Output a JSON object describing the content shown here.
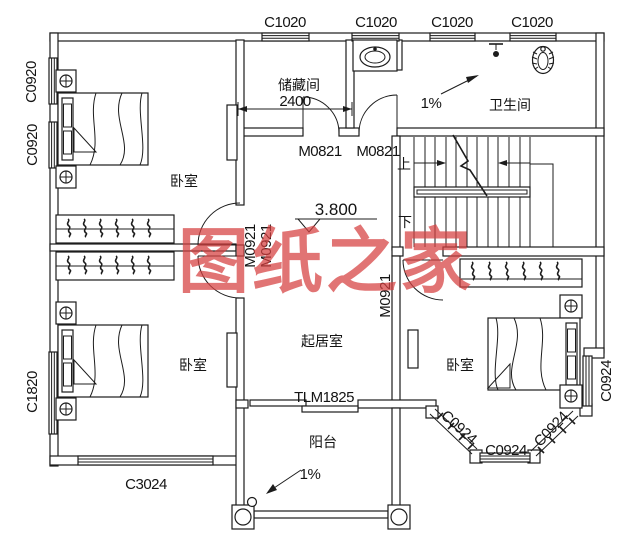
{
  "watermark": {
    "text": "图纸之家",
    "color": "#d64040"
  },
  "windows": {
    "top": [
      "C1020",
      "C1020",
      "C1020",
      "C1020"
    ],
    "left_upper": "C0920",
    "left_lower": "C0920",
    "left_bottom": "C1820",
    "bottom": "C3024",
    "bay": [
      "C0924",
      "C0924",
      "C0924",
      "C0924"
    ]
  },
  "doors": {
    "storage": "M0821",
    "bath": "M0821",
    "bed1_a": "M0921",
    "bed1_b": "M0921",
    "bed3": "M0921",
    "balcony": "TLM1825"
  },
  "rooms": {
    "storage": "储藏间",
    "bathroom": "卫生间",
    "bedroom1": "卧室",
    "bedroom2": "卧室",
    "bedroom3": "卧室",
    "living": "起居室",
    "balcony": "阳台"
  },
  "dimensions": {
    "storage_width": "2400"
  },
  "elevation": "3.800",
  "stairs": {
    "up": "上",
    "down": "下"
  },
  "slopes": {
    "bathroom": "1%",
    "balcony": "1%"
  }
}
